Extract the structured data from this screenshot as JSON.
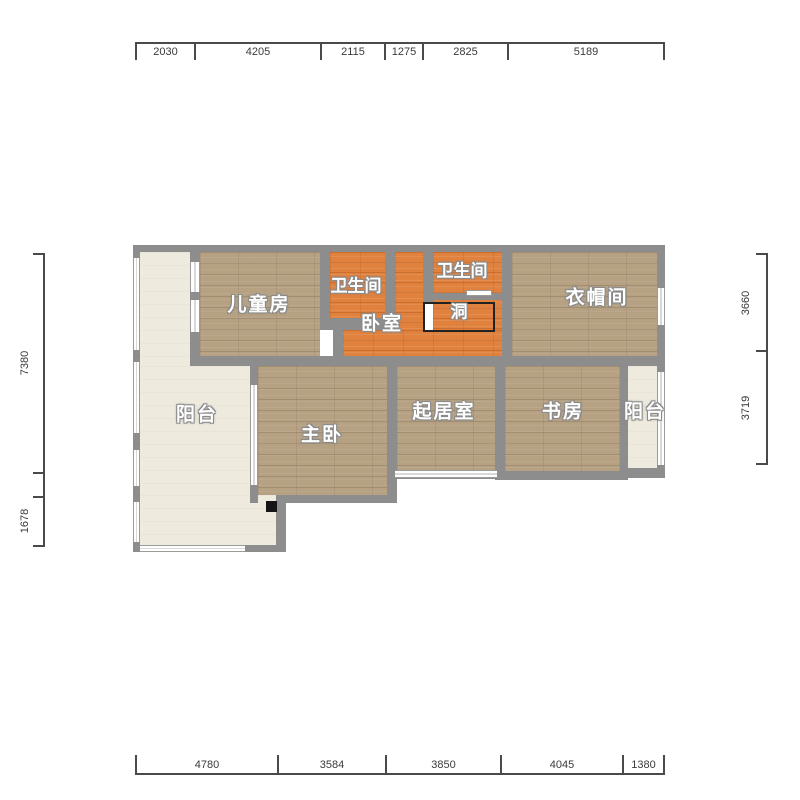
{
  "title": "apartment-floor-plan",
  "colors": {
    "wall": "#8d8d8d",
    "wood_floor": "#b6a183",
    "orange_tile_floor": "#e0813d",
    "balcony_floor": "#efeade",
    "dimension_text": "#3a3a3a",
    "label_text": "#ffffff",
    "label_outline": "#8a8a8a"
  },
  "rooms": {
    "children_room": "儿童房",
    "bath_left": "卫生间",
    "bath_right": "卫生间",
    "bedroom": "卧室",
    "opening": "洞",
    "cloakroom": "衣帽间",
    "balcony_left": "阳台",
    "master_bedroom": "主卧",
    "living_room": "起居室",
    "study": "书房",
    "balcony_right": "阳台"
  },
  "dimensions": {
    "top": [
      "2030",
      "4205",
      "2115",
      "1275",
      "2825",
      "5189"
    ],
    "bottom": [
      "4780",
      "3584",
      "3850",
      "4045",
      "1380"
    ],
    "left": [
      "7380",
      "1678"
    ],
    "right": [
      "3660",
      "3719"
    ]
  }
}
